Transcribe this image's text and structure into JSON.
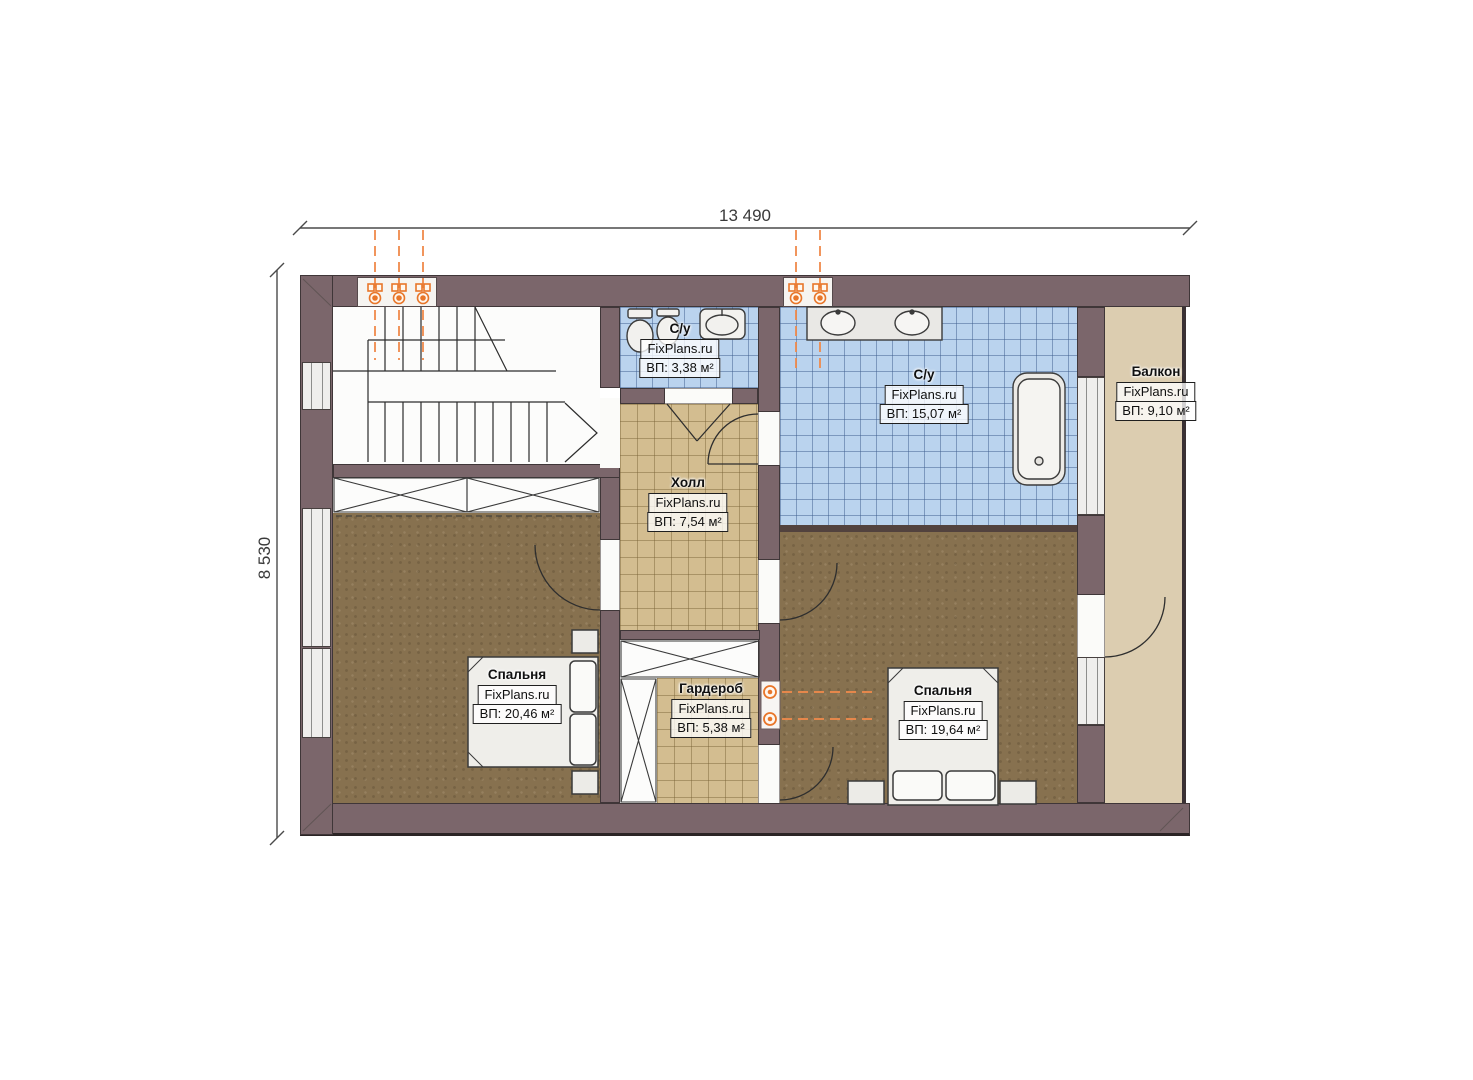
{
  "plan": {
    "dimension_width": "13 490",
    "dimension_height": "8 530"
  },
  "rooms": [
    {
      "key": "bathroom-small",
      "name": "С/у",
      "brand": "FixPlans.ru",
      "area": "ВП: 3,38 м²"
    },
    {
      "key": "bathroom-main",
      "name": "С/у",
      "brand": "FixPlans.ru",
      "area": "ВП: 15,07 м²"
    },
    {
      "key": "balcony",
      "name": "Балкон",
      "brand": "FixPlans.ru",
      "area": "ВП: 9,10 м²"
    },
    {
      "key": "hall",
      "name": "Холл",
      "brand": "FixPlans.ru",
      "area": "ВП: 7,54 м²"
    },
    {
      "key": "bedroom-left",
      "name": "Спальня",
      "brand": "FixPlans.ru",
      "area": "ВП: 20,46 м²"
    },
    {
      "key": "wardrobe",
      "name": "Гардероб",
      "brand": "FixPlans.ru",
      "area": "ВП: 5,38 м²"
    },
    {
      "key": "bedroom-right",
      "name": "Спальня",
      "brand": "FixPlans.ru",
      "area": "ВП: 19,64 м²"
    }
  ],
  "colors": {
    "wall": "#7b666b",
    "tile_blue": "#bad3ee",
    "tile_beige": "#d3bd90",
    "floor_wood": "#87714f",
    "balcony_floor": "#dccdb0",
    "axis_orange": "#ef8a4a"
  }
}
